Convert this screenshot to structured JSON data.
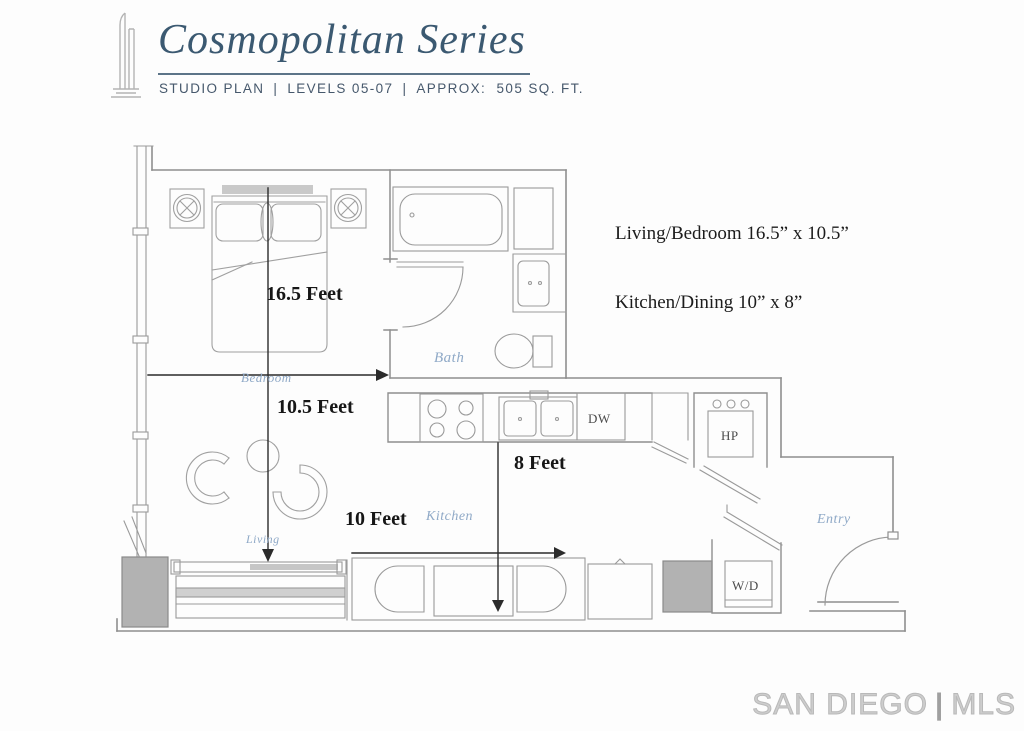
{
  "header": {
    "logo_icon": "tower-icon",
    "brand": "Cosmopolitan Series",
    "plan_type": "STUDIO PLAN",
    "levels": "LEVELS 05-07",
    "area": "APPROX:  505 SQ. FT.",
    "separator": "|"
  },
  "unit_summary": {
    "line1": "Living/Bedroom 16.5” x 10.5”",
    "line2": "Kitchen/Dining 10” x 8”"
  },
  "floor_plan": {
    "dimensions": {
      "living_bedroom_length": "16.5 Feet",
      "living_bedroom_width": "10.5 Feet",
      "kitchen_width": "8 Feet",
      "kitchen_length": "10 Feet"
    },
    "rooms": {
      "bedroom": "Bedroom",
      "bath": "Bath",
      "kitchen": "Kitchen",
      "living": "Living",
      "entry": "Entry"
    },
    "fixtures": {
      "dishwasher": "DW",
      "heat_pump": "HP",
      "washer_dryer": "W/D"
    }
  },
  "watermark": {
    "name": "SAN DIEGO",
    "divider": "|",
    "suffix": "MLS"
  },
  "colors": {
    "brand_text": "#3b5971",
    "subtitle_text": "#46586c",
    "plan_line": "#969696",
    "dimension_line": "#2b2b2b",
    "room_label": "#8fa9c7",
    "column_fill": "#b2b2b2",
    "watermark_text": "#c9c9c9"
  }
}
